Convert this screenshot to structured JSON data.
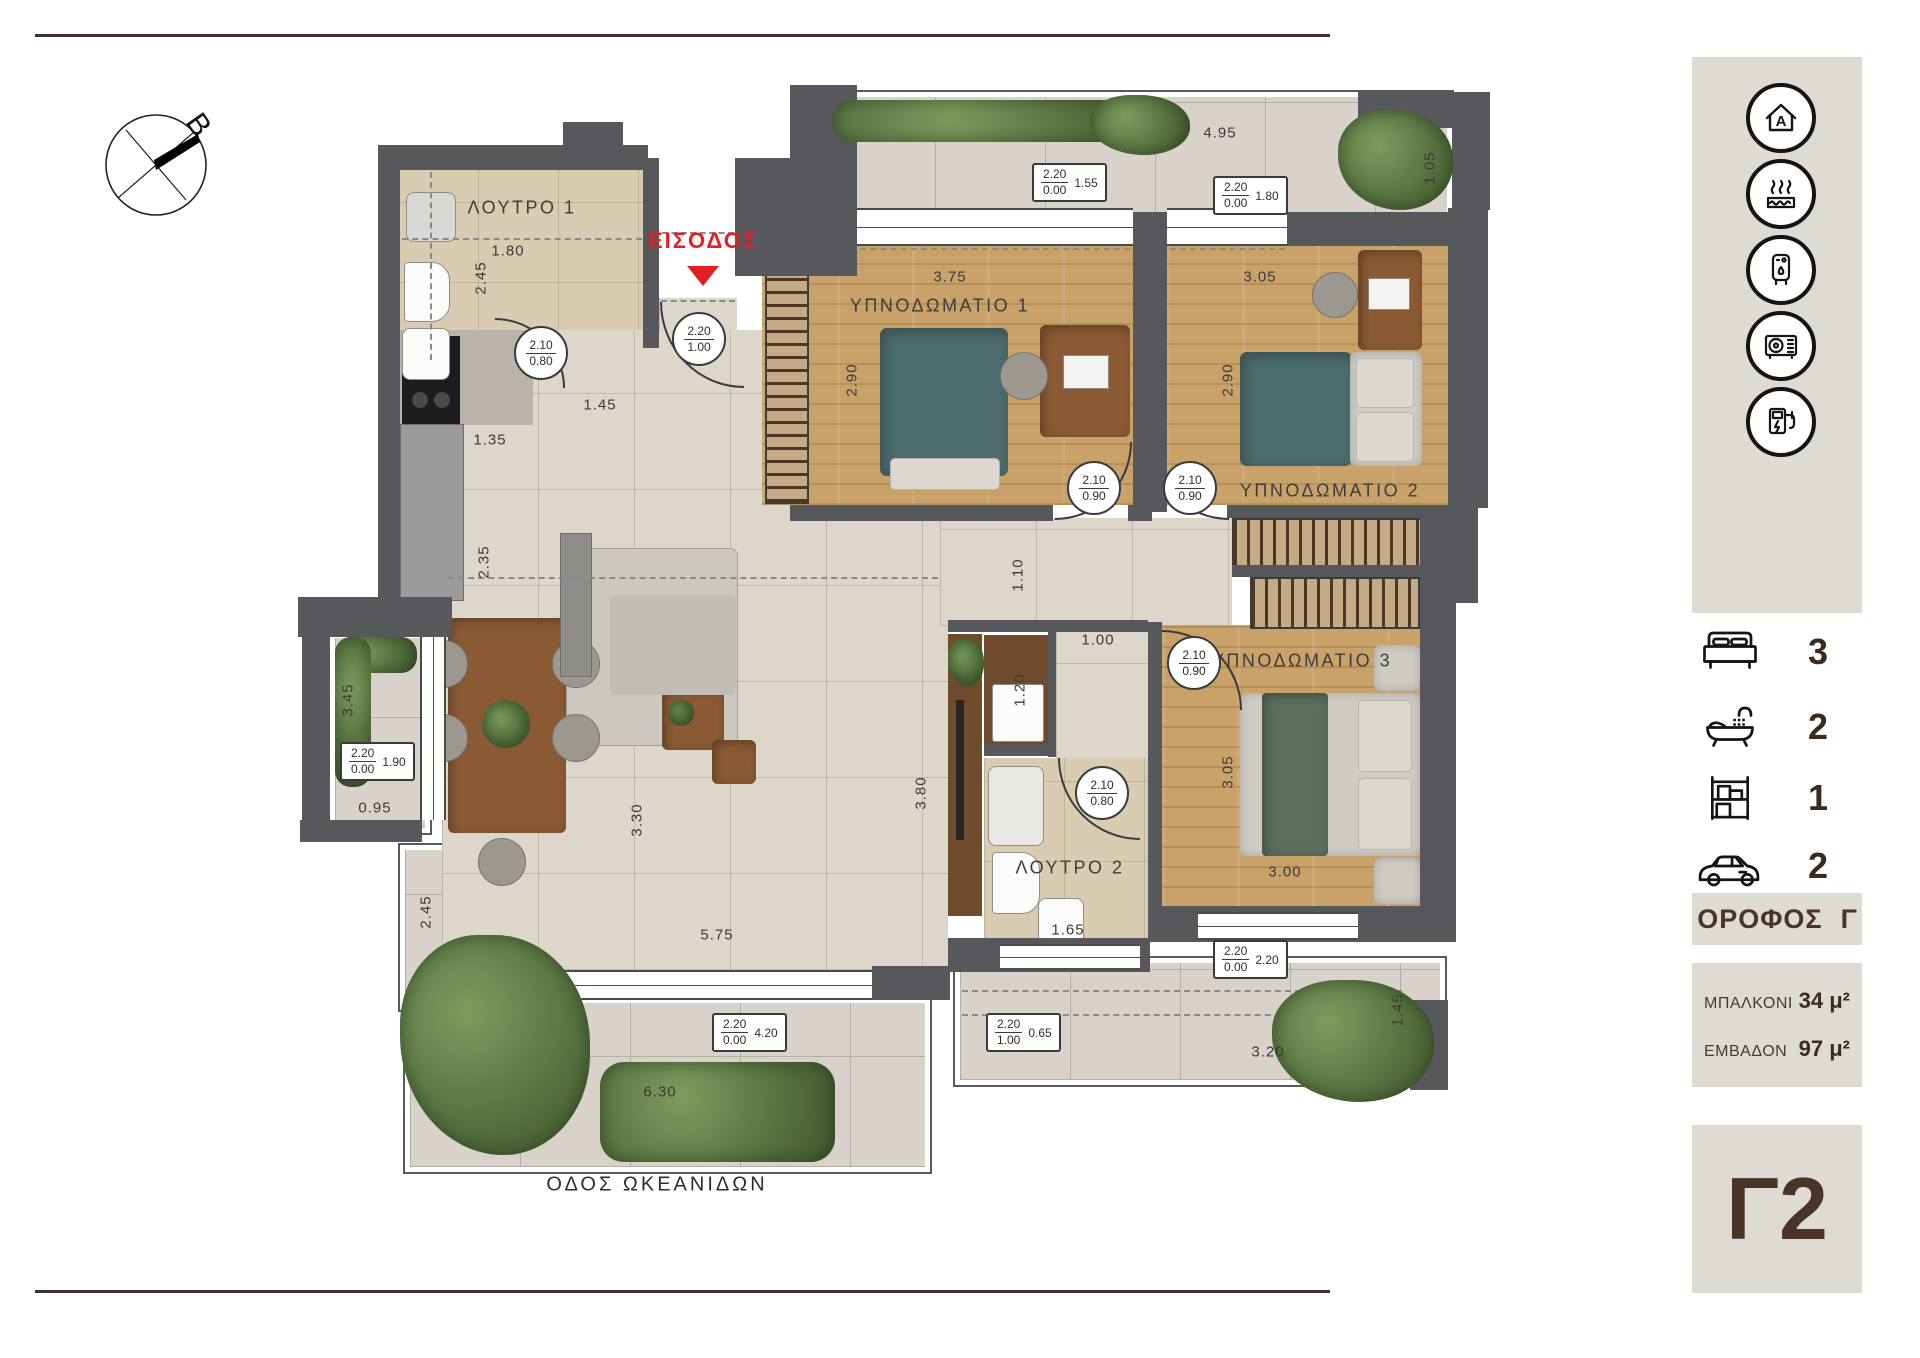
{
  "north_label": "B",
  "entrance_label": "ΕΙΣΟΔΟΣ",
  "street_name": "ΟΔΟΣ ΩΚΕΑΝΙΔΩΝ",
  "rooms": {
    "bath1": "ΛΟΥΤΡΟ 1",
    "bed1": "ΥΠΝΟΔΩΜΑΤΙΟ 1",
    "bed2": "ΥΠΝΟΔΩΜΑΤΙΟ 2",
    "bed3": "ΥΠΝΟΔΩΜΑΤΙΟ 3",
    "bath2": "ΛΟΥΤΡΟ 2"
  },
  "dims": {
    "bath1_w": "1.80",
    "bath1_h": "2.45",
    "bed1_w": "3.75",
    "bed1_h": "2.90",
    "bed2_w": "3.05",
    "bed2_h": "2.90",
    "bed3_w": "3.00",
    "bed3_h": "3.05",
    "hall_w": "1.10",
    "hall2_w": "1.00",
    "closet_w": "1.20",
    "bath2_w": "1.65",
    "living_h": "3.80",
    "living_w": "5.75",
    "dining_h": "3.30",
    "kitchen_h": "2.35",
    "kitchen_w1": "1.35",
    "kitchen_w2": "1.45",
    "balcony_left_h": "3.45",
    "balcony_left_w": "0.95",
    "balcony_top_w": "4.95",
    "balcony_top_h": "1.05",
    "terrace_h": "2.45",
    "terrace_w": "6.30",
    "balcony_br_w": "3.20",
    "balcony_br_h": "1.45"
  },
  "door_markers": [
    {
      "name": "bath1-door",
      "top": "2.10",
      "bottom": "0.80"
    },
    {
      "name": "entrance-door",
      "top": "2.20",
      "bottom": "1.00"
    },
    {
      "name": "bedroom1-door",
      "top": "2.10",
      "bottom": "0.90"
    },
    {
      "name": "bedroom2-door",
      "top": "2.10",
      "bottom": "0.90"
    },
    {
      "name": "bedroom3-door",
      "top": "2.10",
      "bottom": "0.90"
    },
    {
      "name": "bath2-door",
      "top": "2.10",
      "bottom": "0.80"
    }
  ],
  "window_markers": [
    {
      "name": "balcony-top-window-1",
      "top": "2.20",
      "bottom": "0.00",
      "side": "1.55"
    },
    {
      "name": "balcony-top-window-2",
      "top": "2.20",
      "bottom": "0.00",
      "side": "1.80"
    },
    {
      "name": "balcony-left-window",
      "top": "2.20",
      "bottom": "0.00",
      "side": "1.90"
    },
    {
      "name": "bath2-window",
      "top": "2.20",
      "bottom": "1.00",
      "side": "0.65"
    },
    {
      "name": "terrace-window",
      "top": "2.20",
      "bottom": "0.00",
      "side": "4.20"
    },
    {
      "name": "balcony-br-window",
      "top": "2.20",
      "bottom": "0.00",
      "side": "2.20"
    }
  ],
  "sidebar": {
    "features": [
      {
        "name": "energy-class-a-house"
      },
      {
        "name": "underfloor-heating"
      },
      {
        "name": "water-heater"
      },
      {
        "name": "heat-pump-ac"
      },
      {
        "name": "ev-charger"
      }
    ],
    "stats": [
      {
        "name": "bedrooms",
        "value": "3"
      },
      {
        "name": "bathrooms",
        "value": "2"
      },
      {
        "name": "storage",
        "value": "1"
      },
      {
        "name": "parking",
        "value": "2"
      }
    ],
    "floor": {
      "label": "ΟΡΟΦΟΣ",
      "value": "Γ"
    },
    "areas": [
      {
        "label": "ΜΠΑΛΚΟΝΙ",
        "value": "34 μ²"
      },
      {
        "label": "ΕΜΒΑΔΟΝ",
        "value": "97 μ²"
      }
    ],
    "unit_code": "Γ2"
  },
  "colors": {
    "wall": "#57585b",
    "accent_red": "#e31e24",
    "brown": "#4a3428",
    "panel": "#dedbd5"
  }
}
